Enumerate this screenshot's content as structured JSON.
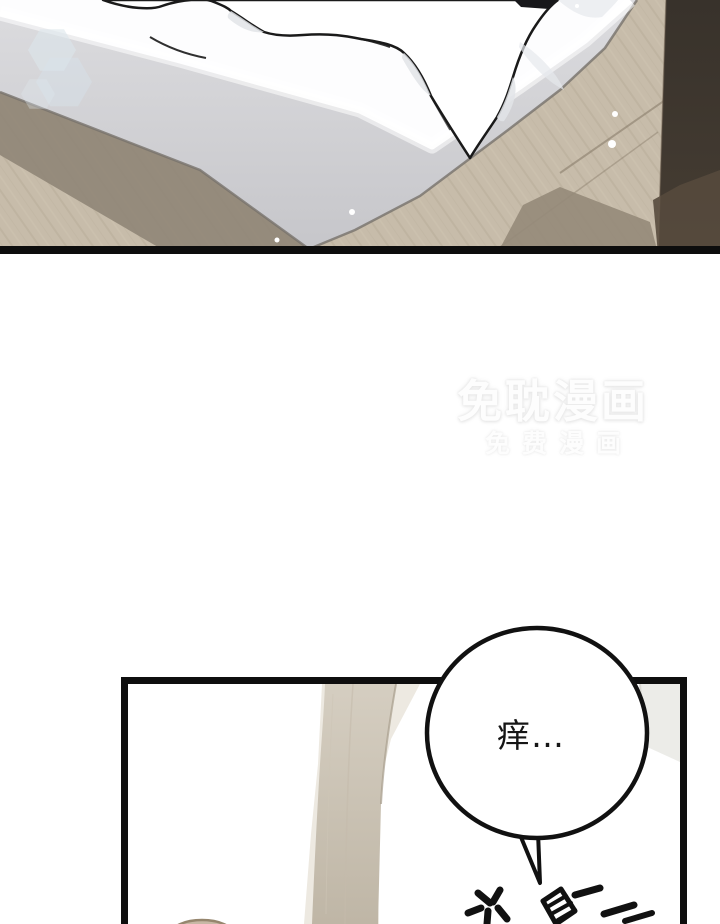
{
  "canvas": {
    "width": 720,
    "height": 924,
    "background": "#ffffff"
  },
  "watermark": {
    "line1": "免耽漫画",
    "line2": "免费漫画",
    "color": "#fdfdfd",
    "glow_color": "#e4e4e4"
  },
  "top_panel": {
    "border_color": "#0d0d0d",
    "colors": {
      "floor_wood": "#c7bcaa",
      "floor_shadow": "#8e8475",
      "mattress_side": "#d6d6d9",
      "mattress_top": "#fdfdfe",
      "bedding": "#ffffff",
      "outline": "#1a1a1a",
      "wall_strip": "#3d362e",
      "lens_flare": "#dce6eb"
    }
  },
  "bottom_panel": {
    "border_color": "#0e0e0e",
    "background": "#ffffff",
    "colors": {
      "fabric_fold": "#cfc7b9",
      "pillow": "#ecece8",
      "foreground_object": "#c8b8a5"
    }
  },
  "speech_bubble": {
    "text": "痒…",
    "fill": "#ffffff",
    "stroke": "#111111"
  },
  "sfx": {
    "visible_text": "※蹭",
    "color": "#111111"
  }
}
